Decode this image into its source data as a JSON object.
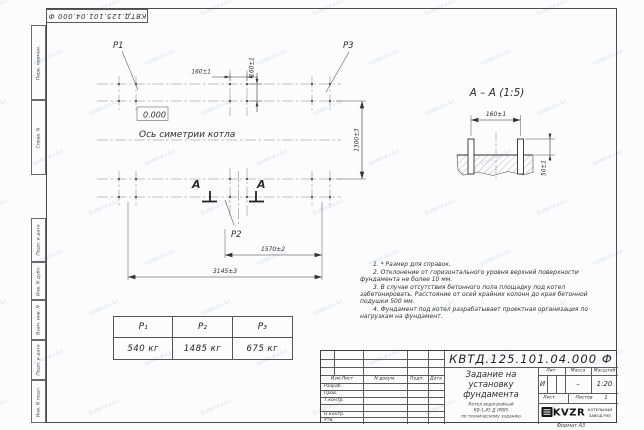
{
  "watermark": {
    "text": "kotel-kv.kz"
  },
  "top_stamp": {
    "doc_number_flipped": "КВТД.125.101.04.000  Ф"
  },
  "margin": {
    "top": [
      "Перв. примен.",
      "Справ. N"
    ],
    "bottom": [
      "Подп. и дата",
      "Инв. N дубл.",
      "Взам. инв. N",
      "Подп. и дата",
      "Инв. N подл."
    ]
  },
  "plan": {
    "p1": "P1",
    "p2": "P2",
    "p3": "P3",
    "level": "0.000",
    "axis_label": "Ось симетрии котла",
    "dim_160_h": "160±1",
    "dim_160_v": "160±1",
    "dim_1300": "1300±3",
    "dim_1570": "1570±2",
    "dim_3145": "3145±3",
    "section_letter_left": "А",
    "section_letter_right": "А"
  },
  "section": {
    "title": "А – А (1:5)",
    "dim_160": "160±1",
    "dim_50": "50±1"
  },
  "loads": {
    "headers": [
      "P₁",
      "P₂",
      "P₃"
    ],
    "values": [
      "540 кг",
      "1485 кг",
      "675 кг"
    ]
  },
  "notes": [
    "1. * Размер для справок.",
    "2. Отклонение от горизонтального уровня верхней поверхности фундамента не более 10 мм.",
    "3. В случае отсутствия бетонного пола площадку под котел забетонировать. Расстояние от осей крайних колонн до края бетонной подушки 500 мм.",
    "4. Фундамент под котел разрабатывает проектная организация по нагрузкам на фундамент."
  ],
  "title_block": {
    "doc_number": "КВТД.125.101.04.000  Ф",
    "title_lines": [
      "Задание на",
      "установку",
      "фундамента"
    ],
    "subtitle_lines": [
      "Котел водогрейный",
      "КВ-1,45 Д (РВР)",
      "по техническому заданию"
    ],
    "header_cols": [
      "Изм.Лист",
      "N докум.",
      "Подп.",
      "Дата"
    ],
    "rows": [
      "Разраб.",
      "Пров.",
      "Т.контр.",
      "",
      "Н.контр.",
      "Утв."
    ],
    "lit_label": "Лит.",
    "mass_label": "Масса",
    "scale_label": "Масштаб",
    "lit_value": "И",
    "mass_value": "–",
    "scale_value": "1:20",
    "sheet_label": "Лист",
    "sheets_label": "Листов",
    "sheets_value": "1",
    "logo_text": "KVZR",
    "logo_caption_lines": [
      "КОТЕЛЬНЫЙ",
      "ЗАВОД РЭП"
    ],
    "format_label": "Формат А3"
  }
}
